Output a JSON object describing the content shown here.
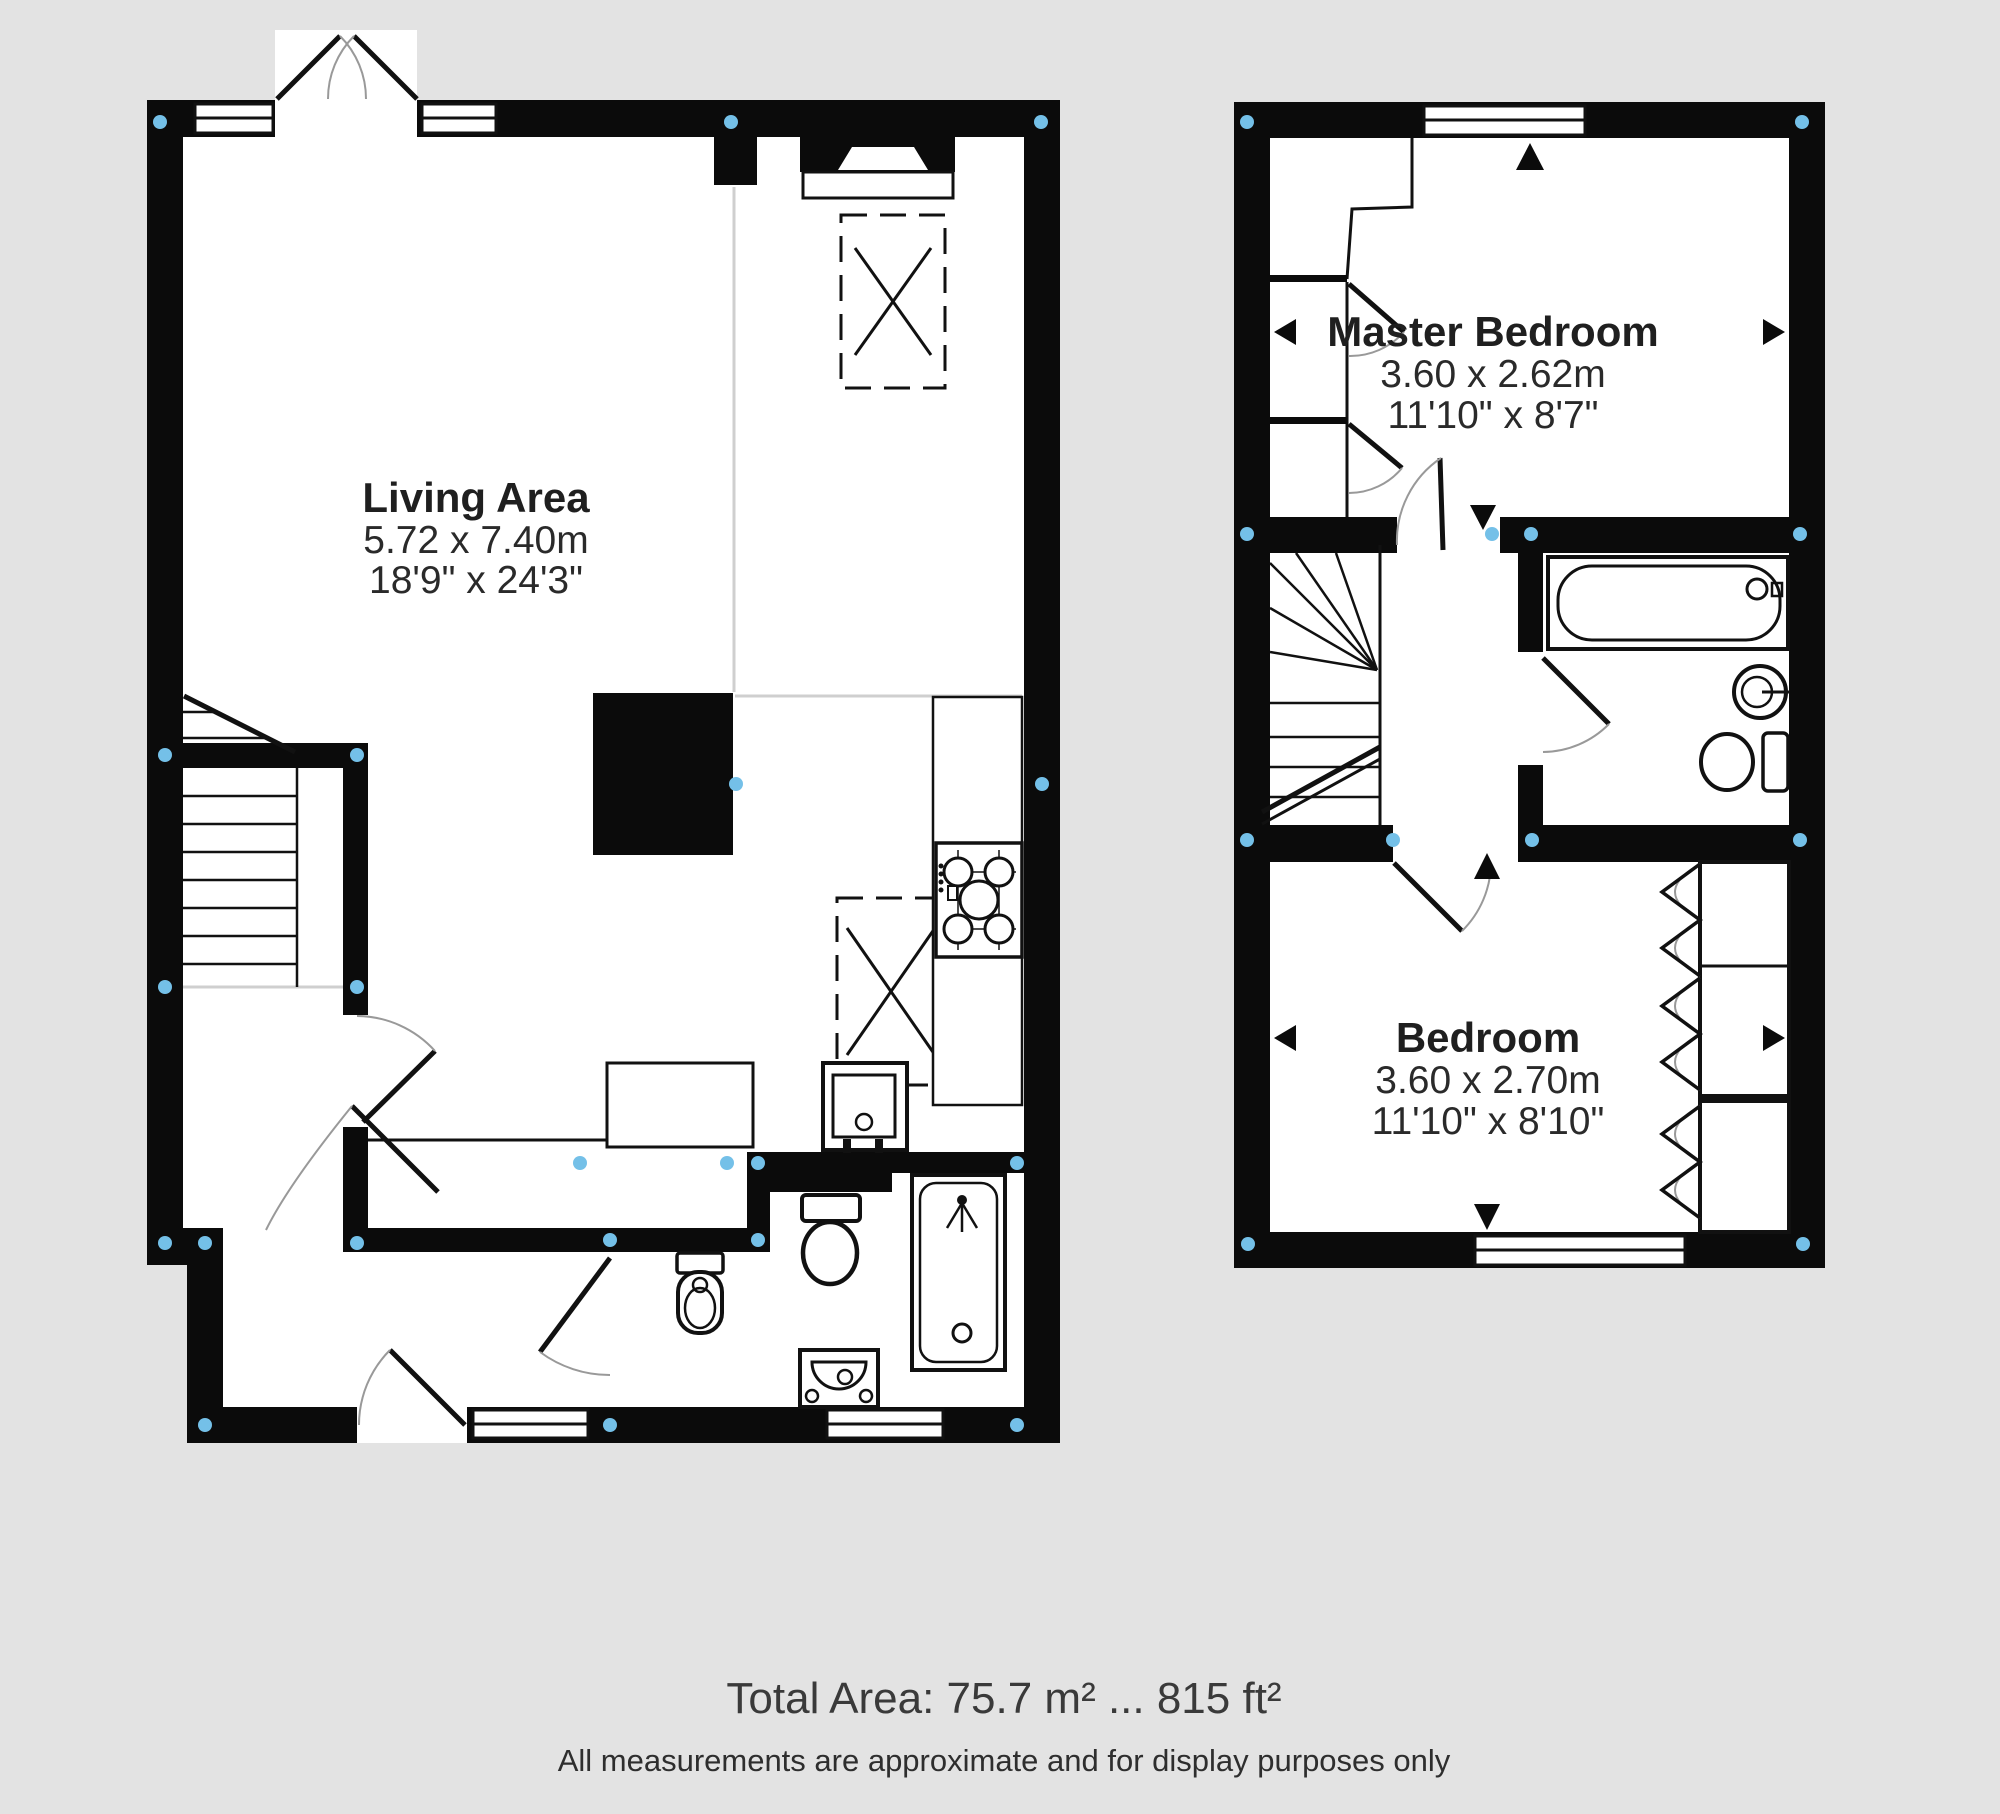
{
  "title": "Two storey floor plan",
  "colors": {
    "background": "#e3e3e3",
    "plan_floor": "#ffffff",
    "wall": "#0b0b0b",
    "marker_blue": "#74c0e8",
    "door_arc_gray": "#999999",
    "boundary_line_gray": "#cfcfcf",
    "text": "#1f1f1f"
  },
  "ground_floor": {
    "living_area": {
      "label": "Living Area",
      "metric": "5.72 x 7.40m",
      "imperial": "18'9\" x 24'3\""
    }
  },
  "first_floor": {
    "master_bedroom": {
      "label": "Master Bedroom",
      "metric": "3.60 x 2.62m",
      "imperial": "11'10\" x 8'7\""
    },
    "bedroom": {
      "label": "Bedroom",
      "metric": "3.60 x 2.70m",
      "imperial": "11'10\" x 8'10\""
    }
  },
  "footer": {
    "total_area": "Total Area: 75.7 m² ... 815 ft²",
    "disclaimer": "All measurements are approximate and for display purposes only"
  }
}
